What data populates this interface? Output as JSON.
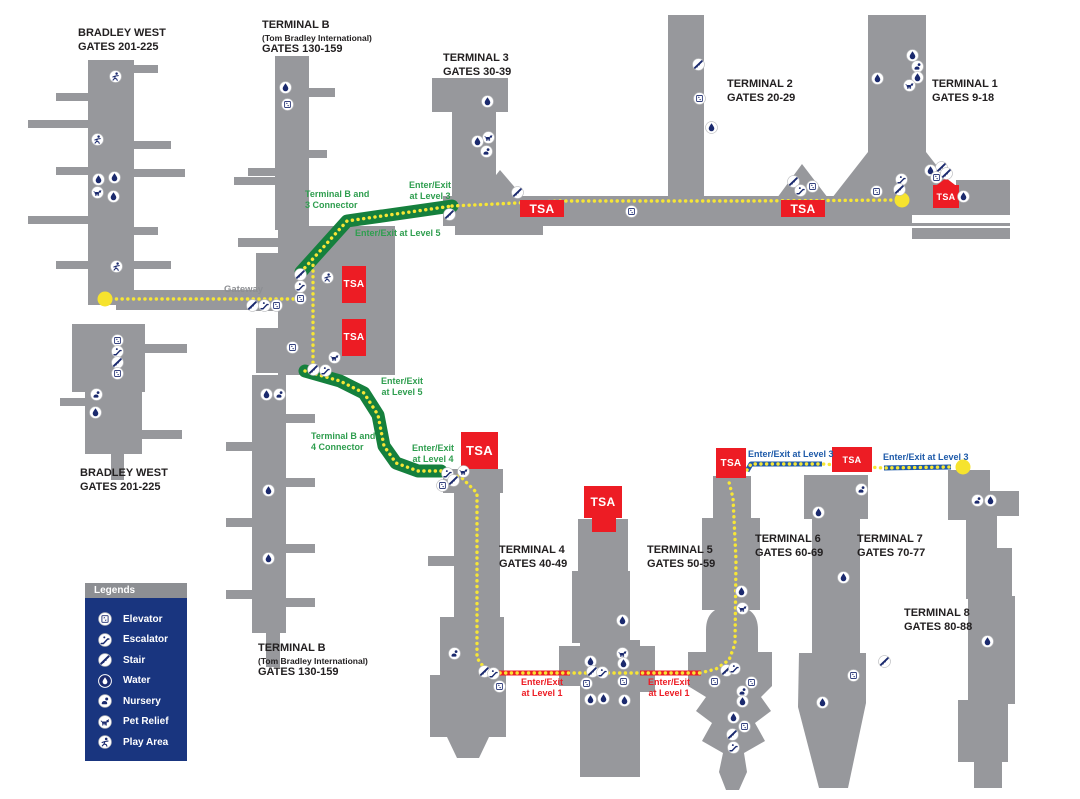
{
  "legend": {
    "title": "Legends",
    "items": [
      {
        "icon": "elevator",
        "label": "Elevator"
      },
      {
        "icon": "escalator",
        "label": "Escalator"
      },
      {
        "icon": "stair",
        "label": "Stair"
      },
      {
        "icon": "water",
        "label": "Water"
      },
      {
        "icon": "nursery",
        "label": "Nursery"
      },
      {
        "icon": "pet-relief",
        "label": "Pet Relief"
      },
      {
        "icon": "play-area",
        "label": "Play Area"
      }
    ]
  },
  "colors": {
    "terminal_gray": "#97989c",
    "path_yellow": "#f7e635",
    "connector_green": "#15803d",
    "green_text": "#2f9e4f",
    "level1_red": "#ed1c24",
    "level3_blue": "#1e5aa9",
    "tsa_red": "#ed1c24",
    "icon_navy": "#1b2a6e",
    "legend_navy": "#19357f",
    "gateway_gray": "#8d8f93"
  },
  "map": {
    "labels": [
      {
        "id": "bradley-west-top",
        "style": "terminal",
        "x": 78,
        "y": 27,
        "text": "BRADLEY WEST\nGATES 201-225"
      },
      {
        "id": "terminal-b-top",
        "style": "terminal",
        "x": 262,
        "y": 19,
        "text": "TERMINAL B\n(Tom Bradley International)\nGATES 130-159"
      },
      {
        "id": "terminal-3",
        "style": "terminal",
        "x": 443,
        "y": 52,
        "text": "TERMINAL 3\nGATES 30-39"
      },
      {
        "id": "terminal-2",
        "style": "terminal",
        "x": 727,
        "y": 78,
        "text": "TERMINAL 2\nGATES 20-29"
      },
      {
        "id": "terminal-1",
        "style": "terminal",
        "x": 932,
        "y": 78,
        "text": "TERMINAL 1\nGATES 9-18"
      },
      {
        "id": "bradley-west-bottom",
        "style": "terminal",
        "x": 80,
        "y": 467,
        "text": "BRADLEY WEST\nGATES 201-225"
      },
      {
        "id": "terminal-b-bottom",
        "style": "terminal",
        "x": 258,
        "y": 642,
        "text": "TERMINAL B\n(Tom Bradley International)\nGATES 130-159"
      },
      {
        "id": "terminal-4",
        "style": "terminal",
        "x": 499,
        "y": 544,
        "text": "TERMINAL 4\nGATES 40-49"
      },
      {
        "id": "terminal-5",
        "style": "terminal",
        "x": 647,
        "y": 544,
        "text": "TERMINAL 5\nGATES 50-59"
      },
      {
        "id": "terminal-6",
        "style": "terminal",
        "x": 755,
        "y": 533,
        "text": "TERMINAL 6\nGATES 60-69"
      },
      {
        "id": "terminal-7",
        "style": "terminal",
        "x": 857,
        "y": 533,
        "text": "TERMINAL 7\nGATES 70-77"
      },
      {
        "id": "terminal-8",
        "style": "terminal",
        "x": 904,
        "y": 607,
        "text": "TERMINAL 8\nGATES 80-88"
      },
      {
        "id": "gateway",
        "style": "gray",
        "x": 224,
        "y": 284,
        "text": "Gateway"
      },
      {
        "id": "connector-b3",
        "style": "green",
        "x": 305,
        "y": 189,
        "text": "Terminal B and\n3 Connector"
      },
      {
        "id": "enter-exit-level3-top",
        "style": "green",
        "align": "center",
        "x": 409,
        "y": 180,
        "text": "Enter/Exit\nat Level 3"
      },
      {
        "id": "enter-exit-level5-top",
        "style": "green",
        "x": 355,
        "y": 228,
        "text": "Enter/Exit at Level 5"
      },
      {
        "id": "enter-exit-level5-mid",
        "style": "green",
        "align": "center",
        "x": 381,
        "y": 376,
        "text": "Enter/Exit\nat Level 5"
      },
      {
        "id": "connector-b4",
        "style": "green",
        "x": 311,
        "y": 431,
        "text": "Terminal B and\n4 Connector"
      },
      {
        "id": "enter-exit-level4",
        "style": "green",
        "align": "center",
        "x": 412,
        "y": 443,
        "text": "Enter/Exit\nat Level 4"
      },
      {
        "id": "enter-exit-level1-a",
        "style": "red",
        "align": "center",
        "x": 521,
        "y": 677,
        "text": "Enter/Exit\nat Level 1"
      },
      {
        "id": "enter-exit-level1-b",
        "style": "red",
        "align": "center",
        "x": 648,
        "y": 677,
        "text": "Enter/Exit\nat Level 1"
      },
      {
        "id": "enter-exit-level3-a",
        "style": "blue",
        "x": 748,
        "y": 449,
        "text": "Enter/Exit at Level 3"
      },
      {
        "id": "enter-exit-level3-b",
        "style": "blue",
        "x": 883,
        "y": 452,
        "text": "Enter/Exit at Level 3"
      }
    ],
    "tsa_boxes": [
      {
        "id": "tsa-terminal-3",
        "label": "TSA",
        "x": 520,
        "y": 200,
        "w": 44,
        "h": 17,
        "fs": 12
      },
      {
        "id": "tsa-terminal-2",
        "label": "TSA",
        "x": 781,
        "y": 200,
        "w": 44,
        "h": 17,
        "fs": 12
      },
      {
        "id": "tsa-terminal-1",
        "label": "TSA",
        "x": 933,
        "y": 185,
        "w": 26,
        "h": 23,
        "fs": 9,
        "arrow": true
      },
      {
        "id": "tsa-terminal-b-upper",
        "label": "TSA",
        "x": 342,
        "y": 266,
        "w": 24,
        "h": 37,
        "fs": 10
      },
      {
        "id": "tsa-terminal-b-lower",
        "label": "TSA",
        "x": 342,
        "y": 319,
        "w": 24,
        "h": 37,
        "fs": 10
      },
      {
        "id": "tsa-terminal-4",
        "label": "TSA",
        "x": 461,
        "y": 432,
        "w": 37,
        "h": 37,
        "fs": 13
      },
      {
        "id": "tsa-terminal-5",
        "label": "TSA",
        "x": 584,
        "y": 486,
        "w": 38,
        "h": 32,
        "fs": 12
      },
      {
        "id": "tsa-terminal-5-stem",
        "label": "",
        "x": 592,
        "y": 517,
        "w": 24,
        "h": 15,
        "fs": 0
      },
      {
        "id": "tsa-terminal-6",
        "label": "TSA",
        "x": 716,
        "y": 448,
        "w": 30,
        "h": 30,
        "fs": 10
      },
      {
        "id": "tsa-terminal-7",
        "label": "TSA",
        "x": 832,
        "y": 447,
        "w": 40,
        "h": 25,
        "fs": 9
      }
    ],
    "route_endpoints": [
      {
        "x": 105,
        "y": 299
      },
      {
        "x": 902,
        "y": 200
      },
      {
        "x": 963,
        "y": 467
      }
    ],
    "amenity_icons": [
      {
        "t": "play-area",
        "x": 115,
        "y": 76
      },
      {
        "t": "play-area",
        "x": 97,
        "y": 139
      },
      {
        "t": "water",
        "x": 98,
        "y": 179
      },
      {
        "t": "water",
        "x": 114,
        "y": 177
      },
      {
        "t": "pet-relief",
        "x": 97,
        "y": 192
      },
      {
        "t": "water",
        "x": 113,
        "y": 196
      },
      {
        "t": "play-area",
        "x": 116,
        "y": 266
      },
      {
        "t": "elevator",
        "x": 117,
        "y": 340
      },
      {
        "t": "escalator",
        "x": 117,
        "y": 351
      },
      {
        "t": "stair",
        "x": 117,
        "y": 362
      },
      {
        "t": "elevator",
        "x": 117,
        "y": 373
      },
      {
        "t": "nursery",
        "x": 96,
        "y": 394
      },
      {
        "t": "water",
        "x": 95,
        "y": 412
      },
      {
        "t": "water",
        "x": 285,
        "y": 87
      },
      {
        "t": "elevator",
        "x": 287,
        "y": 104
      },
      {
        "t": "stair",
        "x": 252,
        "y": 305
      },
      {
        "t": "escalator",
        "x": 264,
        "y": 305
      },
      {
        "t": "elevator",
        "x": 276,
        "y": 305
      },
      {
        "t": "stair",
        "x": 300,
        "y": 274
      },
      {
        "t": "escalator",
        "x": 300,
        "y": 286
      },
      {
        "t": "elevator",
        "x": 300,
        "y": 298
      },
      {
        "t": "play-area",
        "x": 327,
        "y": 277
      },
      {
        "t": "elevator",
        "x": 292,
        "y": 347
      },
      {
        "t": "pet-relief",
        "x": 334,
        "y": 357
      },
      {
        "t": "stair",
        "x": 313,
        "y": 369
      },
      {
        "t": "escalator",
        "x": 325,
        "y": 370
      },
      {
        "t": "water",
        "x": 266,
        "y": 394
      },
      {
        "t": "nursery",
        "x": 279,
        "y": 394
      },
      {
        "t": "water",
        "x": 268,
        "y": 490
      },
      {
        "t": "water",
        "x": 268,
        "y": 558
      },
      {
        "t": "water",
        "x": 487,
        "y": 101
      },
      {
        "t": "pet-relief",
        "x": 488,
        "y": 137
      },
      {
        "t": "water",
        "x": 477,
        "y": 141
      },
      {
        "t": "nursery",
        "x": 486,
        "y": 151
      },
      {
        "t": "stair",
        "x": 517,
        "y": 192
      },
      {
        "t": "elevator",
        "x": 631,
        "y": 211
      },
      {
        "t": "stair",
        "x": 793,
        "y": 181
      },
      {
        "t": "escalator",
        "x": 800,
        "y": 190
      },
      {
        "t": "elevator",
        "x": 812,
        "y": 186
      },
      {
        "t": "stair",
        "x": 698,
        "y": 64
      },
      {
        "t": "elevator",
        "x": 699,
        "y": 98
      },
      {
        "t": "water",
        "x": 711,
        "y": 127
      },
      {
        "t": "water",
        "x": 877,
        "y": 78
      },
      {
        "t": "water",
        "x": 912,
        "y": 55
      },
      {
        "t": "nursery",
        "x": 917,
        "y": 66
      },
      {
        "t": "water",
        "x": 917,
        "y": 77
      },
      {
        "t": "pet-relief",
        "x": 909,
        "y": 85
      },
      {
        "t": "stair",
        "x": 941,
        "y": 167
      },
      {
        "t": "water",
        "x": 930,
        "y": 170
      },
      {
        "t": "elevator",
        "x": 936,
        "y": 177
      },
      {
        "t": "stair",
        "x": 946,
        "y": 173
      },
      {
        "t": "escalator",
        "x": 901,
        "y": 179
      },
      {
        "t": "stair",
        "x": 899,
        "y": 189
      },
      {
        "t": "elevator",
        "x": 876,
        "y": 191
      },
      {
        "t": "water",
        "x": 963,
        "y": 196
      },
      {
        "t": "stair",
        "x": 449,
        "y": 214
      },
      {
        "t": "escalator",
        "x": 447,
        "y": 473
      },
      {
        "t": "stair",
        "x": 453,
        "y": 480
      },
      {
        "t": "elevator",
        "x": 442,
        "y": 485
      },
      {
        "t": "pet-relief",
        "x": 463,
        "y": 471
      },
      {
        "t": "nursery",
        "x": 454,
        "y": 653
      },
      {
        "t": "stair",
        "x": 484,
        "y": 671
      },
      {
        "t": "escalator",
        "x": 493,
        "y": 673
      },
      {
        "t": "elevator",
        "x": 499,
        "y": 686
      },
      {
        "t": "water",
        "x": 622,
        "y": 620
      },
      {
        "t": "pet-relief",
        "x": 622,
        "y": 653
      },
      {
        "t": "water",
        "x": 590,
        "y": 661
      },
      {
        "t": "water",
        "x": 623,
        "y": 663
      },
      {
        "t": "stair",
        "x": 592,
        "y": 671
      },
      {
        "t": "escalator",
        "x": 602,
        "y": 672
      },
      {
        "t": "elevator",
        "x": 586,
        "y": 683
      },
      {
        "t": "elevator",
        "x": 623,
        "y": 681
      },
      {
        "t": "water",
        "x": 590,
        "y": 699
      },
      {
        "t": "water",
        "x": 603,
        "y": 698
      },
      {
        "t": "water",
        "x": 624,
        "y": 700
      },
      {
        "t": "water",
        "x": 741,
        "y": 591
      },
      {
        "t": "pet-relief",
        "x": 742,
        "y": 608
      },
      {
        "t": "stair",
        "x": 726,
        "y": 670
      },
      {
        "t": "escalator",
        "x": 734,
        "y": 668
      },
      {
        "t": "elevator",
        "x": 714,
        "y": 681
      },
      {
        "t": "elevator",
        "x": 751,
        "y": 682
      },
      {
        "t": "nursery",
        "x": 742,
        "y": 691
      },
      {
        "t": "water",
        "x": 742,
        "y": 701
      },
      {
        "t": "water",
        "x": 733,
        "y": 717
      },
      {
        "t": "elevator",
        "x": 744,
        "y": 726
      },
      {
        "t": "stair",
        "x": 732,
        "y": 734
      },
      {
        "t": "escalator",
        "x": 733,
        "y": 747
      },
      {
        "t": "nursery",
        "x": 861,
        "y": 489
      },
      {
        "t": "water",
        "x": 818,
        "y": 512
      },
      {
        "t": "water",
        "x": 843,
        "y": 577
      },
      {
        "t": "stair",
        "x": 884,
        "y": 661
      },
      {
        "t": "elevator",
        "x": 853,
        "y": 675
      },
      {
        "t": "water",
        "x": 822,
        "y": 702
      },
      {
        "t": "nursery",
        "x": 977,
        "y": 500
      },
      {
        "t": "water",
        "x": 990,
        "y": 500
      },
      {
        "t": "water",
        "x": 987,
        "y": 641
      }
    ]
  }
}
